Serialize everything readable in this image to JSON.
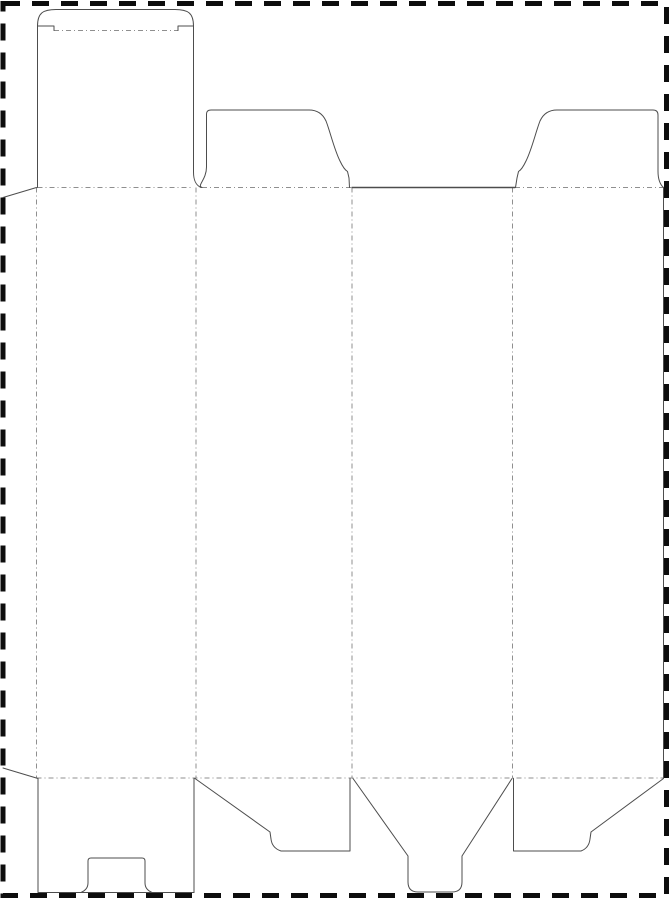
{
  "dieline": {
    "title": "",
    "canvas": {
      "width": 671,
      "height": 900
    },
    "colors": {
      "background": "#ffffff",
      "page_border": "#0d0d0d",
      "cut_line": "#4d4d4d",
      "fold_line": "#8f8f8f"
    },
    "page_border": {
      "x": 3,
      "y": 3.5,
      "width": 663.5,
      "height": 892,
      "stroke_width": 5,
      "dash": "17 12"
    },
    "stroke": {
      "cut_width": 1,
      "fold_width": 1,
      "fold_dash": "5 3 1 3"
    },
    "cut_paths": [
      {
        "name": "glue-flap-top-edge",
        "d": "M 3,197.5 L 36.5,187.5"
      },
      {
        "name": "glue-flap-bottom-edge",
        "d": "M 3,768 L 38,778.5"
      },
      {
        "name": "tuck-flap-left-edge",
        "d": "M 37.5,187.5 L 37.5,25"
      },
      {
        "name": "tuck-flap-left-shoulder",
        "d": "M 37.5,26 L 54,26 L 54,30.5"
      },
      {
        "name": "tuck-flap-top-arc",
        "d": "M 37.5,26 C 37.5,13 43,9.5 56,9.5 L 175,9.5 C 188,9.5 193.5,13 193.5,26"
      },
      {
        "name": "tuck-flap-right-shoulder",
        "d": "M 178,30.5 L 178,26 L 193.5,26"
      },
      {
        "name": "tuck-flap-right-edge",
        "d": "M 193.5,26 L 193.5,172 C 193.5,180 195.5,185 201,187.5"
      },
      {
        "name": "left-dust-flap-outline",
        "d": "M 202,187.5 C 196.5,185.5 206.5,180 206.5,167 L 206.5,114 Q 206.5,110 211,110 L 309,110 Q 321,110 326,121 C 330,131 334,149 340,161 Q 344,169.5 347.5,171.5 L 349,178 L 349.5,187.5"
      },
      {
        "name": "top-center-cut-edge",
        "d": "M 352,187.5 L 515,187.5",
        "w": 1.4
      },
      {
        "name": "right-dust-flap-outline",
        "d": "M 515.5,187.5 L 517,178 L 518.5,171.5 Q 522,169.5 526,161 C 532,149 536,131 540,121 Q 545,110 557,110 L 653,110 Q 658,110 658,115 L 658,171 C 658,179 659.5,184 663.5,187.5"
      },
      {
        "name": "right-panel-edge",
        "d": "M 663.5,187.5 L 663.5,778"
      },
      {
        "name": "bottom-flap-1-left-edge",
        "d": "M 38,778.5 L 38,892.5"
      },
      {
        "name": "bottom-flap-1-right-edge",
        "d": "M 194,778.5 L 194,892.5"
      },
      {
        "name": "bottom-flap-1-bottom-edge",
        "d": "M 38,892.5 L 194,892.5"
      },
      {
        "name": "bottom-flap-1-lock-slot",
        "d": "M 81,892.5 Q 88,889.5 88,883 L 88,861 Q 88,858 91,858 L 142,858 Q 145,858 145,861 L 145,883 Q 145,889.5 152,892.5"
      },
      {
        "name": "bottom-dust-flap-left",
        "d": "M 195,778.5 L 270,832 L 271,839 Q 272,848 281,851 L 350,851 L 350,778.5"
      },
      {
        "name": "bottom-lock-tab-flap",
        "d": "M 353,778.5 L 408,856 L 408,882 Q 408,892 418,892 L 452,892 Q 462,892 462,882 L 462,856 L 512,778.5"
      },
      {
        "name": "bottom-dust-flap-right",
        "d": "M 513.5,778.5 L 513.5,851 L 581,851 Q 589,848 590,839 L 591,832 L 663.5,778.5"
      }
    ],
    "fold_lines": [
      {
        "name": "tuck-flap-fold",
        "x1": 54,
        "y1": 30.5,
        "x2": 178,
        "y2": 30.5
      },
      {
        "name": "glue-flap-fold",
        "x1": 36.5,
        "y1": 187.5,
        "x2": 36.5,
        "y2": 778
      },
      {
        "name": "panel-1-2-fold",
        "x1": 196,
        "y1": 187.5,
        "x2": 196,
        "y2": 778
      },
      {
        "name": "panel-2-3-fold",
        "x1": 352,
        "y1": 187.5,
        "x2": 352,
        "y2": 778
      },
      {
        "name": "panel-3-4-fold",
        "x1": 512.5,
        "y1": 187.5,
        "x2": 512.5,
        "y2": 778
      },
      {
        "name": "top-fold-panel-1",
        "x1": 37.5,
        "y1": 187.5,
        "x2": 193.5,
        "y2": 187.5
      },
      {
        "name": "top-fold-panel-2",
        "x1": 202,
        "y1": 187.5,
        "x2": 352,
        "y2": 187.5
      },
      {
        "name": "top-fold-panel-4",
        "x1": 515,
        "y1": 187.5,
        "x2": 663.5,
        "y2": 187.5
      },
      {
        "name": "bottom-fold",
        "x1": 36.5,
        "y1": 778,
        "x2": 663.5,
        "y2": 778
      }
    ]
  }
}
